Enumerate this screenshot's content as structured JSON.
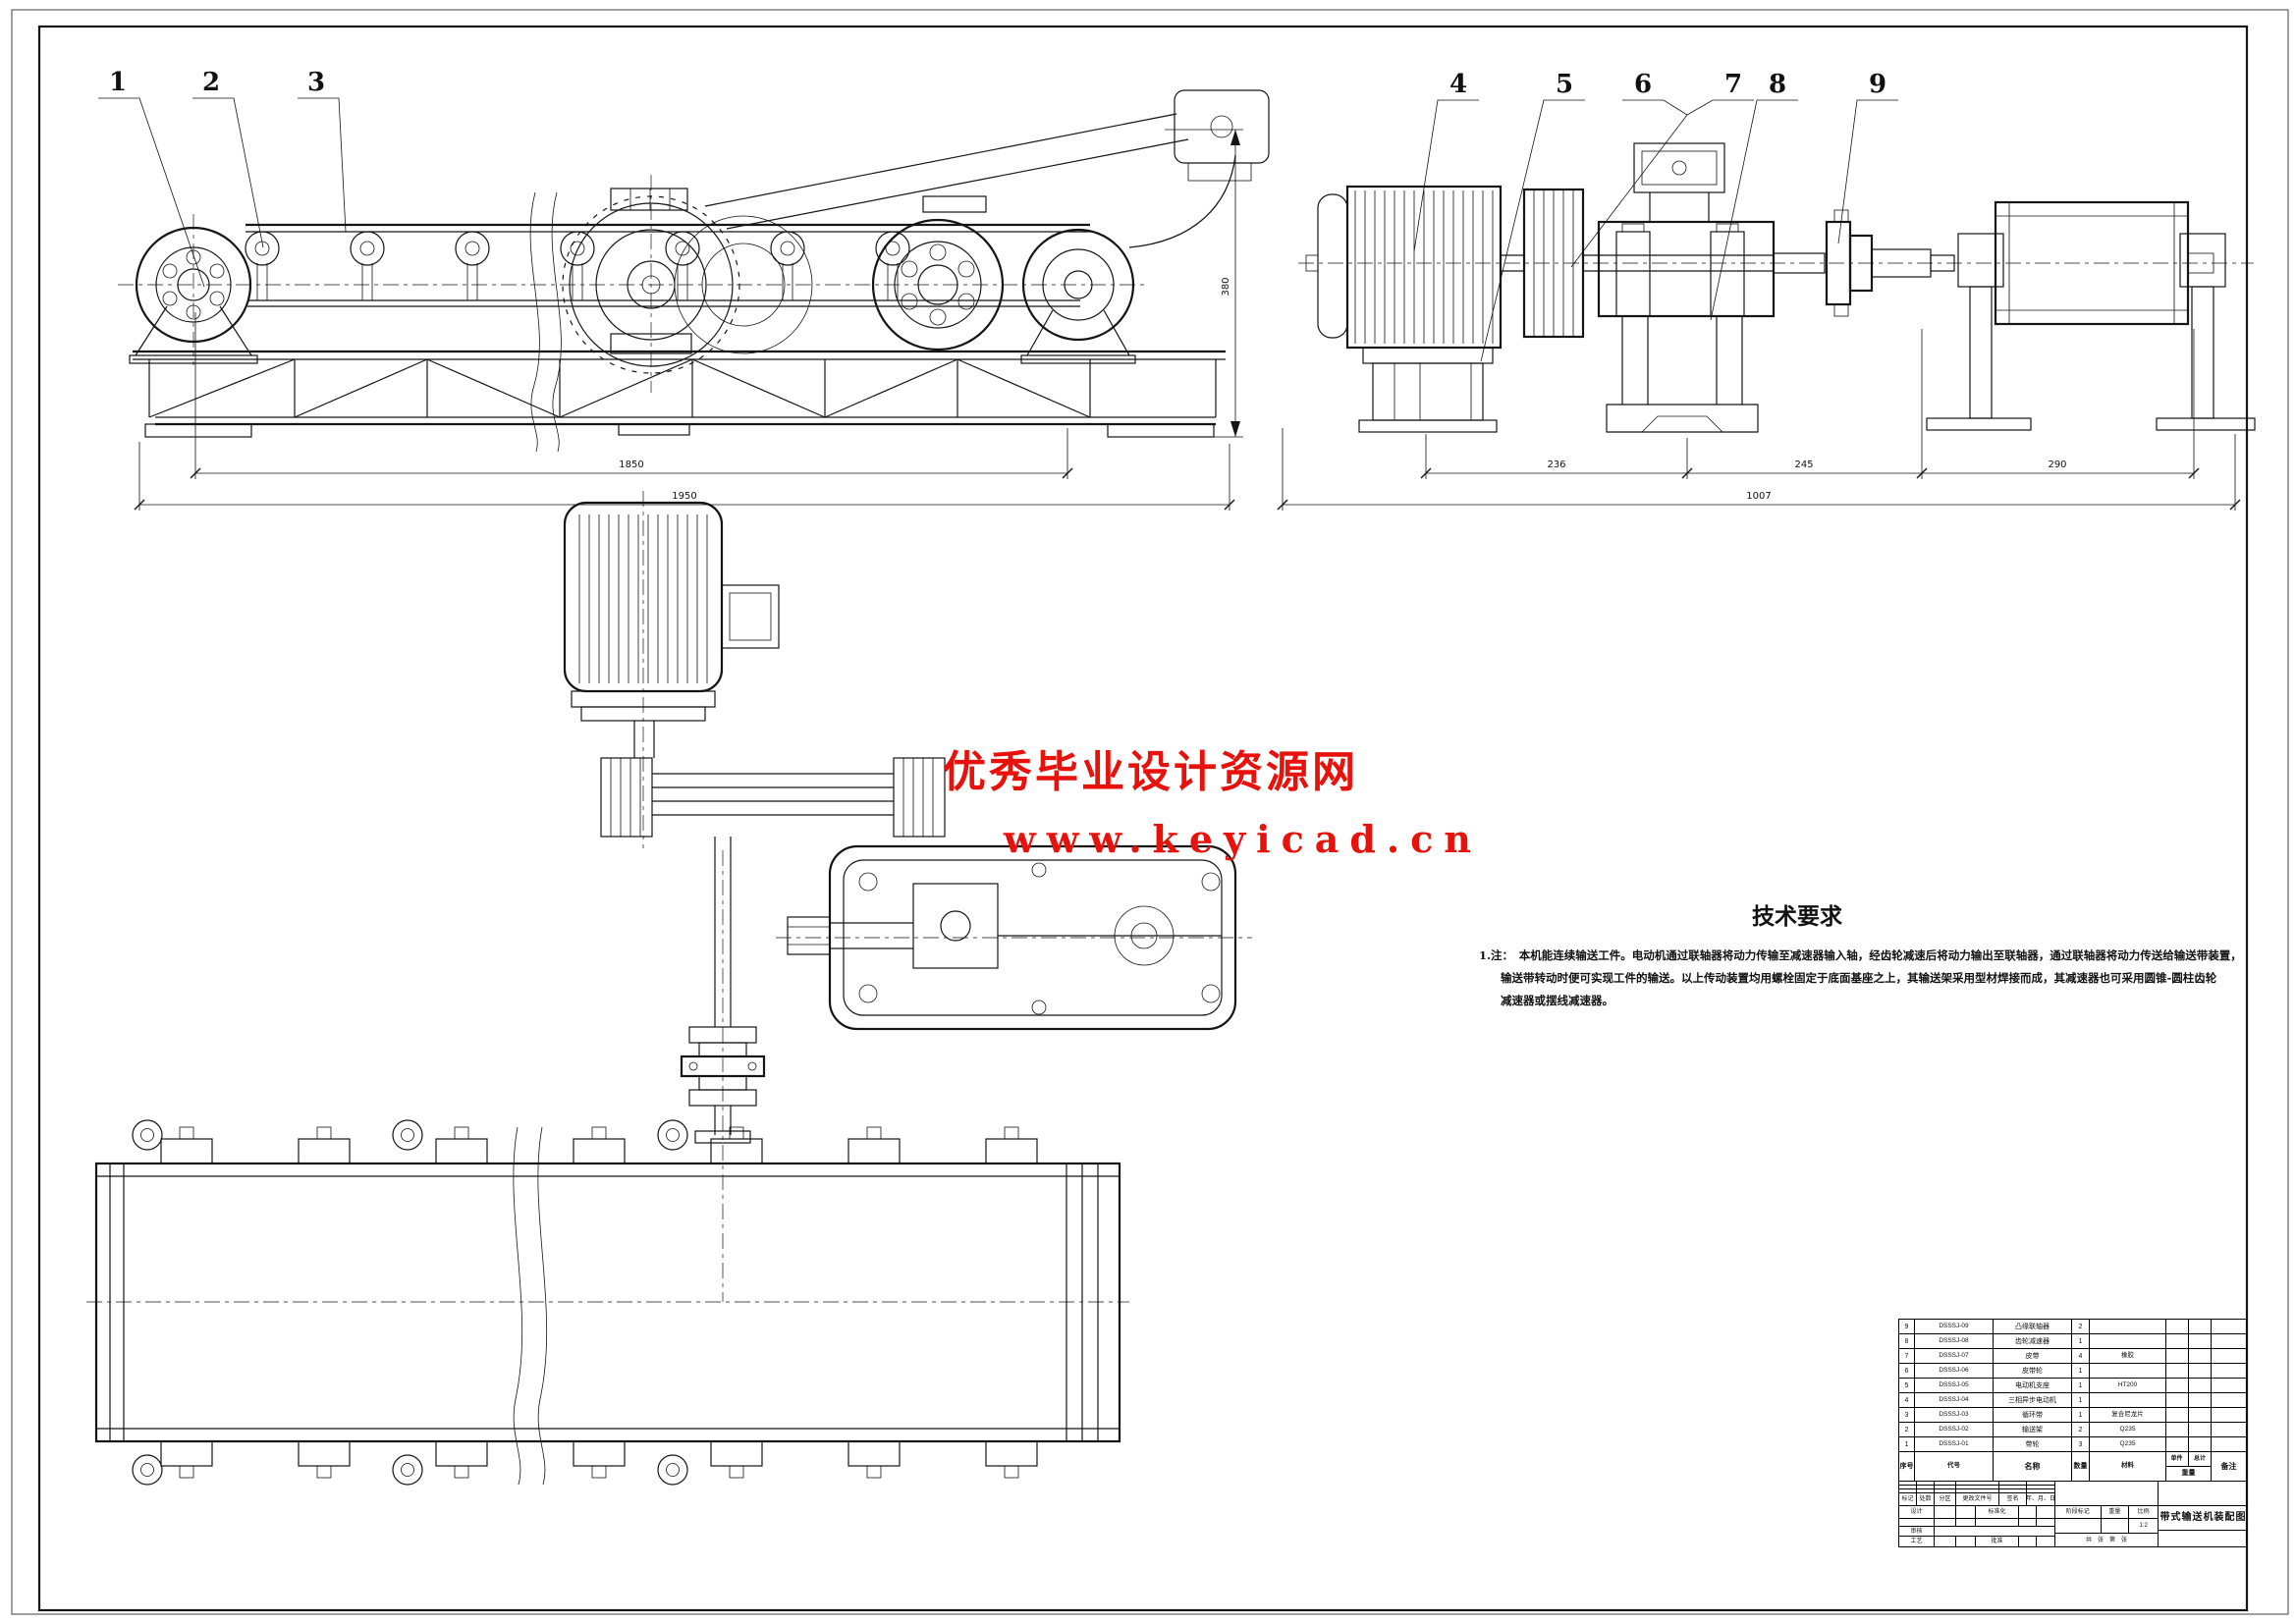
{
  "sheet": {
    "background": "#ffffff",
    "line_color": "#151515",
    "accent_red": "#e8120c"
  },
  "watermark": {
    "line1": "优秀毕业设计资源网",
    "line2": "www.keyicad.cn",
    "color": "#e8120c"
  },
  "callouts": {
    "c1": "1",
    "c2": "2",
    "c3": "3",
    "c4": "4",
    "c5": "5",
    "c6": "6",
    "c7": "7",
    "c8": "8",
    "c9": "9"
  },
  "dimensions": {
    "left_inner": "1850",
    "left_outer": "1950",
    "left_height": "380",
    "right_seg1": "236",
    "right_seg2": "245",
    "right_seg3": "290",
    "right_total": "1007"
  },
  "tech_req": {
    "title": "技术要求",
    "note_prefix": "1.注：",
    "line1": "本机能连续输送工件。电动机通过联轴器将动力传输至减速器输入轴，经齿轮减速后将动力输出至联轴器，通过联轴器将动力传送给输送带装置，",
    "line2": "输送带转动时便可实现工件的输送。以上传动装置均用螺栓固定于底面基座之上，其输送架采用型材焊接而成，其减速器也可采用圆锥-圆柱齿轮",
    "line3": "减速器或摆线减速器。"
  },
  "parts_list": {
    "headers": {
      "no": "序号",
      "code": "代号",
      "name": "名称",
      "qty": "数量",
      "material": "材料",
      "unit": "单件",
      "total": "总计",
      "weight": "重量",
      "remarks": "备注"
    },
    "rows": [
      {
        "no": "9",
        "code": "DSSSJ-09",
        "name": "凸缘联轴器",
        "qty": "2",
        "material": "",
        "remarks": ""
      },
      {
        "no": "8",
        "code": "DSSSJ-08",
        "name": "齿轮减速器",
        "qty": "1",
        "material": "",
        "remarks": ""
      },
      {
        "no": "7",
        "code": "DSSSJ-07",
        "name": "皮带",
        "qty": "4",
        "material": "橡胶",
        "remarks": ""
      },
      {
        "no": "6",
        "code": "DSSSJ-06",
        "name": "皮带轮",
        "qty": "1",
        "material": "",
        "remarks": ""
      },
      {
        "no": "5",
        "code": "DSSSJ-05",
        "name": "电动机支座",
        "qty": "1",
        "material": "HT200",
        "remarks": ""
      },
      {
        "no": "4",
        "code": "DSSSJ-04",
        "name": "三相异步电动机",
        "qty": "1",
        "material": "",
        "remarks": ""
      },
      {
        "no": "3",
        "code": "DSSSJ-03",
        "name": "循环带",
        "qty": "1",
        "material": "复合尼龙片",
        "remarks": ""
      },
      {
        "no": "2",
        "code": "DSSSJ-02",
        "name": "输送架",
        "qty": "2",
        "material": "Q235",
        "remarks": ""
      },
      {
        "no": "1",
        "code": "DSSSJ-01",
        "name": "带轮",
        "qty": "3",
        "material": "Q235",
        "remarks": ""
      }
    ]
  },
  "title_block": {
    "title": "带式输送机装配图",
    "scale": "1:2",
    "labels": {
      "mark": "标记",
      "count": "处数",
      "zone": "分区",
      "doc_no": "更改文件号",
      "sign": "签名",
      "date": "年、月、日",
      "design": "设计",
      "standard": "标准化",
      "check": "审核",
      "process": "工艺",
      "approve": "批准",
      "stage": "阶段标记",
      "weight": "重量",
      "ratio": "比例",
      "sheets": "共　张　第　张"
    }
  }
}
